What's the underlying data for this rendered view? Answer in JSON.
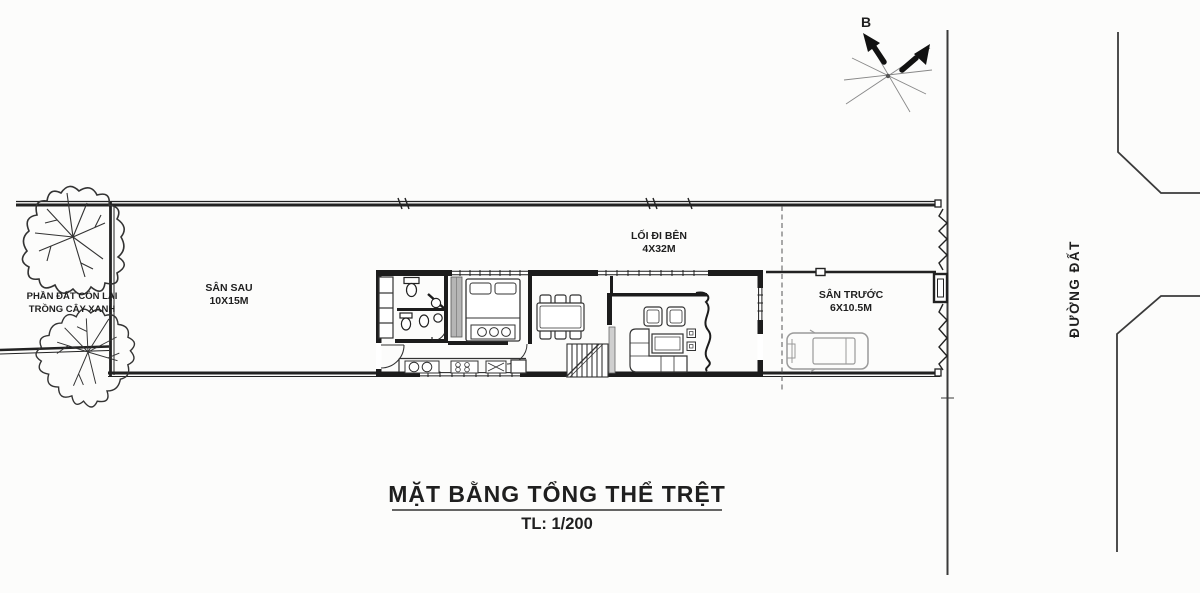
{
  "compass": {
    "north_label": "B"
  },
  "site": {
    "green_area": {
      "line1": "PHẦN ĐẤT CÒN LẠI",
      "line2": "TRỒNG CÂY XANH"
    },
    "back_yard": {
      "name": "SÂN SAU",
      "size": "10X15M"
    },
    "side_walkway": {
      "name": "LỐI ĐI BÊN",
      "size": "4X32M"
    },
    "front_yard": {
      "name": "SÂN TRƯỚC",
      "size": "6X10.5M"
    },
    "road_label": "ĐƯỜNG ĐẤT"
  },
  "title_block": {
    "title": "MẶT BẰNG TỔNG THỂ TRỆT",
    "scale": "TL: 1/200"
  },
  "colors": {
    "line": "#1c1c1c",
    "boundary": "#222222",
    "gray": "#9a9a9a",
    "road": "#3a3a3a"
  }
}
